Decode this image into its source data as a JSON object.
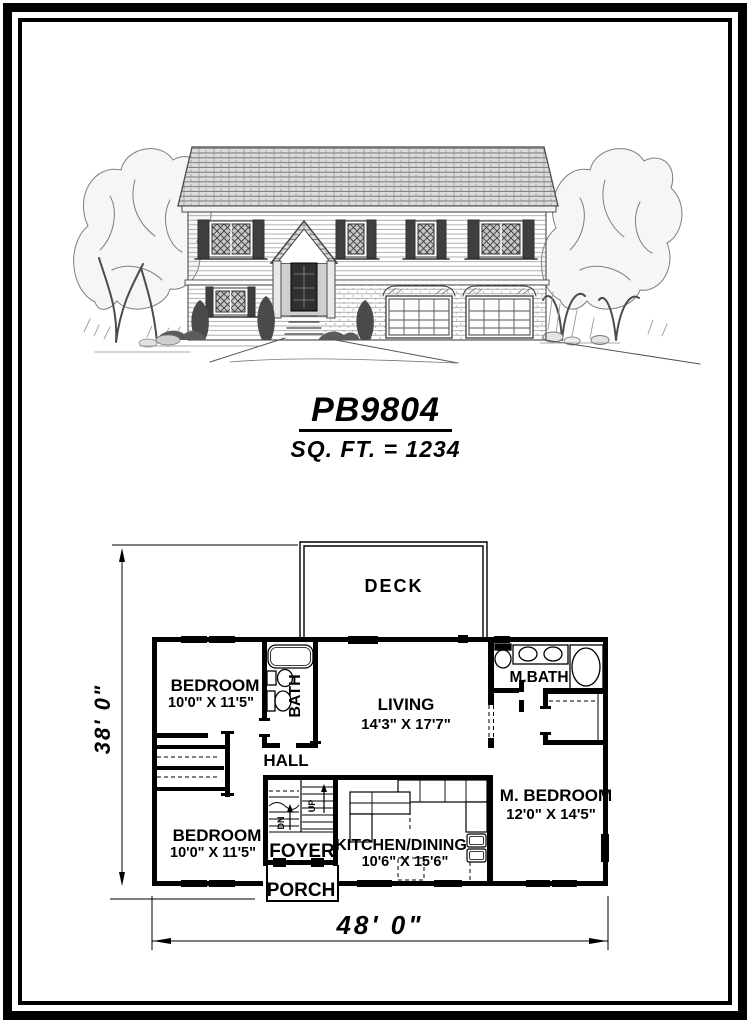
{
  "title": {
    "code": "PB9804",
    "sqft": "SQ. FT. = 1234"
  },
  "plan": {
    "labels": {
      "deck": "DECK",
      "bedroom_top": {
        "name": "BEDROOM",
        "dims": "10'0\" X 11'5\""
      },
      "bath": "BATH",
      "living": {
        "name": "LIVING",
        "dims": "14'3\" X 17'7\""
      },
      "mbath": "M.BATH",
      "hall": "HALL",
      "mbedroom": {
        "name": "M. BEDROOM",
        "dims": "12'0\" X 14'5\""
      },
      "bedroom_bottom": {
        "name": "BEDROOM",
        "dims": "10'0\" X 11'5\""
      },
      "foyer": "FOYER",
      "kitchen": {
        "name": "KITCHEN/DINING",
        "dims": "10'6\" X 15'6\""
      },
      "porch": "PORCH",
      "up": "UP",
      "down": "DN"
    },
    "dimensions": {
      "width": "48' 0\"",
      "depth": "38' 0\""
    }
  },
  "colors": {
    "ink": "#000000",
    "pencil": "#555555"
  }
}
